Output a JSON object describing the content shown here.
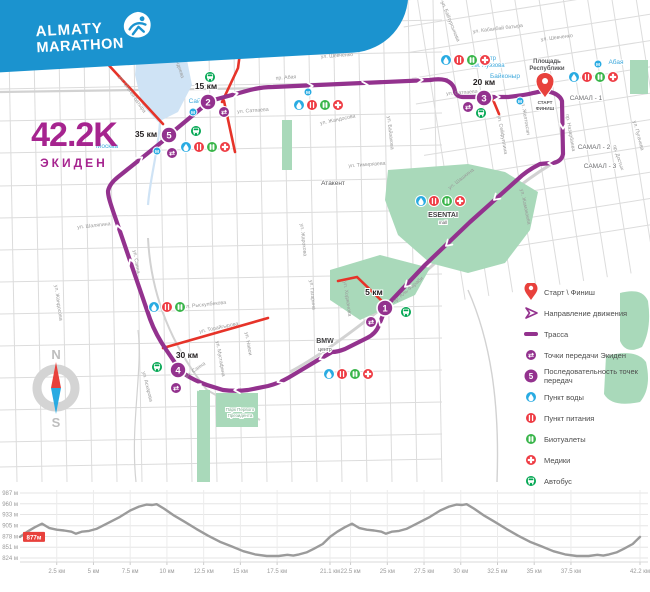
{
  "colors": {
    "brand_blue": "#1b93cf",
    "purple": "#93328e",
    "magenta": "#a6248f",
    "water_blue": "#29abe2",
    "food_red": "#ee3b43",
    "wc_green": "#39b54a",
    "bus_green": "#00a651",
    "park": "#a9d9ba",
    "water_area": "#cfe3f5",
    "red_road": "#e63329",
    "street": "#dcdcdc",
    "street_label": "#9a9a9a",
    "pin_red": "#e8413c",
    "chart_line": "#9b9b9b"
  },
  "logo": {
    "line1": "ALMATY",
    "line2": "MARATHON"
  },
  "race": {
    "distance": "42.2K",
    "type": "ЭКИДЕН"
  },
  "compass": {
    "north": "N",
    "south": "S"
  },
  "map": {
    "start": {
      "x": 545,
      "y": 88,
      "labels": [
        "СТАРТ",
        "ФИНИШ"
      ]
    },
    "km_markers": [
      {
        "num": "1",
        "label": "5 км",
        "x": 385,
        "y": 308,
        "lx": 374,
        "ly": 295
      },
      {
        "num": "2",
        "label": "15 км",
        "x": 208,
        "y": 102,
        "lx": 206,
        "ly": 89
      },
      {
        "num": "3",
        "label": "20 км",
        "x": 484,
        "y": 98,
        "lx": 484,
        "ly": 85
      },
      {
        "num": "4",
        "label": "30 км",
        "x": 178,
        "y": 370,
        "lx": 187,
        "ly": 358
      },
      {
        "num": "5",
        "label": "35 км",
        "x": 169,
        "y": 135,
        "lx": 146,
        "ly": 137
      }
    ],
    "icons": [
      [
        "water",
        446,
        60
      ],
      [
        "food",
        459,
        60
      ],
      [
        "wc",
        472,
        60
      ],
      [
        "medic",
        485,
        60
      ],
      [
        "water",
        574,
        77
      ],
      [
        "food",
        587,
        77
      ],
      [
        "wc",
        600,
        77
      ],
      [
        "medic",
        613,
        77
      ],
      [
        "water",
        299,
        105
      ],
      [
        "food",
        312,
        105
      ],
      [
        "wc",
        325,
        105
      ],
      [
        "medic",
        338,
        105
      ],
      [
        "water",
        186,
        147
      ],
      [
        "food",
        199,
        147
      ],
      [
        "wc",
        212,
        147
      ],
      [
        "medic",
        225,
        147
      ],
      [
        "water",
        329,
        374
      ],
      [
        "food",
        342,
        374
      ],
      [
        "wc",
        355,
        374
      ],
      [
        "medic",
        368,
        374
      ],
      [
        "water",
        421,
        201
      ],
      [
        "food",
        434,
        201
      ],
      [
        "wc",
        447,
        201
      ],
      [
        "medic",
        460,
        201
      ],
      [
        "water",
        154,
        307
      ],
      [
        "food",
        167,
        307
      ],
      [
        "wc",
        180,
        307
      ],
      [
        "bus",
        210,
        77
      ],
      [
        "bus",
        196,
        131
      ],
      [
        "bus",
        481,
        113
      ],
      [
        "bus",
        406,
        312
      ],
      [
        "bus",
        157,
        367
      ],
      [
        "exchange",
        224,
        112
      ],
      [
        "exchange",
        172,
        153
      ],
      [
        "exchange",
        468,
        107
      ],
      [
        "exchange",
        371,
        322
      ],
      [
        "exchange",
        176,
        388
      ],
      [
        "metro",
        308,
        92
      ],
      [
        "metro",
        193,
        112
      ],
      [
        "metro",
        520,
        101
      ],
      [
        "metro",
        598,
        64
      ],
      [
        "metro",
        157,
        151
      ]
    ],
    "streets": [
      [
        "ул. Шевченко",
        337,
        57,
        -4
      ],
      [
        "ул. Шевченко",
        557,
        39,
        -7
      ],
      [
        "ул. Кабанбай батыра",
        498,
        30,
        -7
      ],
      [
        "ул. Байтурсынова",
        449,
        22,
        68
      ],
      [
        "пр. Абая",
        286,
        79,
        -4
      ],
      [
        "ул. Сатпаева",
        253,
        112,
        -4
      ],
      [
        "ул. Сатпаева",
        462,
        94,
        -4
      ],
      [
        "ул. Тимирязева",
        367,
        166,
        -4
      ],
      [
        "ул. Жандосова",
        338,
        121,
        -12
      ],
      [
        "ул. Жарокова",
        302,
        240,
        84
      ],
      [
        "ул. Гагарина",
        311,
        295,
        84
      ],
      [
        "ул. Байзакова",
        389,
        133,
        84
      ],
      [
        "ул. Сейфуллина",
        501,
        135,
        80
      ],
      [
        "ул. Желтоксан",
        524,
        118,
        80
      ],
      [
        "пр. Назарбаева",
        569,
        133,
        80
      ],
      [
        "ул. Пугачева",
        637,
        136,
        75
      ],
      [
        "пр. Достык",
        617,
        158,
        72
      ],
      [
        "ул. Шашкина",
        462,
        180,
        -38
      ],
      [
        "ул. Жамакаева",
        524,
        207,
        78
      ],
      [
        "ул. Ходжанова",
        346,
        299,
        82
      ],
      [
        "пр. Аль-Фараби",
        409,
        291,
        -40
      ],
      [
        "ул. Навои",
        247,
        344,
        80
      ],
      [
        "ул. Мустафина",
        219,
        359,
        80
      ],
      [
        "ул. Торайгырова",
        219,
        329,
        -12
      ],
      [
        "ул. Рыскулбекова",
        205,
        306,
        -6
      ],
      [
        "ул. Саина",
        196,
        371,
        -35
      ],
      [
        "ул. Аскарова",
        146,
        387,
        76
      ],
      [
        "ул. Саина",
        135,
        262,
        80
      ],
      [
        "ул. Жандосова",
        57,
        303,
        82
      ],
      [
        "ул. Шаляпина",
        94,
        227,
        -6
      ],
      [
        "ул. Отеген батыра",
        131,
        95,
        55
      ],
      [
        "ул. Тлендиева",
        176,
        62,
        72
      ]
    ],
    "places_blue": [
      [
        "Сайран",
        200,
        103,
        6.5
      ],
      [
        "Москва",
        107,
        148,
        6.5
      ],
      [
        "Байконыр",
        505,
        78,
        6.5
      ],
      [
        "Театр",
        488,
        60,
        6
      ],
      [
        "им. Ауэзова",
        488,
        67,
        6
      ],
      [
        "Абая",
        616,
        64,
        6.5
      ]
    ],
    "places_dark": [
      [
        "Площадь",
        547,
        63,
        6,
        "bold",
        "#58585a"
      ],
      [
        "Республики",
        547,
        70,
        6,
        "bold",
        "#58585a"
      ],
      [
        "Атакент",
        333,
        185,
        6.5,
        "normal",
        "#58585a"
      ],
      [
        "САМАЛ - 1",
        586,
        100,
        6.5,
        "normal",
        "#6d6e71"
      ],
      [
        "САМАЛ - 2",
        594,
        149,
        6.5,
        "normal",
        "#6d6e71"
      ],
      [
        "САМАЛ - 3",
        600,
        168,
        6.5,
        "normal",
        "#6d6e71"
      ],
      [
        "BMW",
        325,
        343,
        7,
        "bold",
        "#414042"
      ],
      [
        "центр",
        325,
        351,
        5,
        "normal",
        "#58585a"
      ],
      [
        "ESENTAI",
        443,
        217,
        7,
        "bold",
        "#414042"
      ],
      [
        "mall",
        443,
        224,
        4.5,
        "normal",
        "#58585a"
      ],
      [
        "Парк Первого",
        240,
        411,
        4.5,
        "normal",
        "#79a98b"
      ],
      [
        "Президента",
        240,
        417,
        4.5,
        "normal",
        "#79a98b"
      ]
    ]
  },
  "legend": {
    "items": [
      {
        "icon": "pin",
        "label": "Старт \\ Финиш"
      },
      {
        "icon": "direction",
        "label": "Направление движения"
      },
      {
        "icon": "track",
        "label": "Трасса"
      },
      {
        "icon": "exchange",
        "label": "Точки передачи Экиден"
      },
      {
        "icon": "number",
        "label": "Последовательность точек передач",
        "num": "5"
      },
      {
        "icon": "water",
        "label": "Пункт воды"
      },
      {
        "icon": "food",
        "label": "Пункт питания"
      },
      {
        "icon": "wc",
        "label": "Биотуалеты"
      },
      {
        "icon": "medic",
        "label": "Медики"
      },
      {
        "icon": "bus",
        "label": "Автобус"
      }
    ]
  },
  "chart_data": {
    "type": "line",
    "title": "",
    "xlabel": "",
    "ylabel": "",
    "xlim": [
      0,
      42.2
    ],
    "ylim": [
      824,
      987
    ],
    "grid": true,
    "legend_position": "none",
    "start_badge": "877м",
    "x_ticks": [
      [
        "2.5 км",
        2.5
      ],
      [
        "5 км",
        5
      ],
      [
        "7.5 км",
        7.5
      ],
      [
        "10 км",
        10
      ],
      [
        "12.5 км",
        12.5
      ],
      [
        "15 км",
        15
      ],
      [
        "17.5 км",
        17.5
      ],
      [
        "21.1 км",
        21.1
      ],
      [
        "22.5 км",
        22.5
      ],
      [
        "25 км",
        25
      ],
      [
        "27.5 км",
        27.5
      ],
      [
        "30 км",
        30
      ],
      [
        "32.5 км",
        32.5
      ],
      [
        "35 км",
        35
      ],
      [
        "37.5 км",
        37.5
      ],
      [
        "42.2 км",
        42.2
      ]
    ],
    "y_ticks": [
      [
        "987 м",
        987
      ],
      [
        "960 м",
        960
      ],
      [
        "933 м",
        933
      ],
      [
        "905 м",
        905
      ],
      [
        "878 м",
        878
      ],
      [
        "851 м",
        851
      ],
      [
        "824 м",
        824
      ]
    ],
    "series": [
      {
        "name": "elevation",
        "points": [
          [
            0,
            877
          ],
          [
            0.5,
            890
          ],
          [
            1.0,
            901
          ],
          [
            1.5,
            910
          ],
          [
            2.0,
            899
          ],
          [
            2.5,
            895
          ],
          [
            3.0,
            893
          ],
          [
            3.5,
            890
          ],
          [
            3.8,
            885
          ],
          [
            4.2,
            890
          ],
          [
            4.7,
            892
          ],
          [
            5.2,
            897
          ],
          [
            6.0,
            912
          ],
          [
            6.8,
            927
          ],
          [
            7.5,
            943
          ],
          [
            8.1,
            953
          ],
          [
            8.6,
            958
          ],
          [
            9.0,
            957
          ],
          [
            9.3,
            959
          ],
          [
            9.8,
            948
          ],
          [
            10.5,
            930
          ],
          [
            11.2,
            915
          ],
          [
            12.0,
            897
          ],
          [
            12.8,
            880
          ],
          [
            13.6,
            865
          ],
          [
            14.4,
            853
          ],
          [
            15.2,
            841
          ],
          [
            16.0,
            833
          ],
          [
            16.8,
            829
          ],
          [
            17.6,
            829
          ],
          [
            18.2,
            832
          ],
          [
            18.6,
            830
          ],
          [
            19.0,
            833
          ],
          [
            19.5,
            838
          ],
          [
            20.0,
            847
          ],
          [
            20.6,
            859
          ],
          [
            21.1,
            877
          ],
          [
            21.6,
            890
          ],
          [
            22.1,
            901
          ],
          [
            22.6,
            910
          ],
          [
            23.1,
            899
          ],
          [
            23.6,
            895
          ],
          [
            24.1,
            893
          ],
          [
            24.6,
            890
          ],
          [
            24.9,
            885
          ],
          [
            25.3,
            890
          ],
          [
            25.8,
            892
          ],
          [
            26.3,
            897
          ],
          [
            27.1,
            912
          ],
          [
            27.9,
            927
          ],
          [
            28.6,
            943
          ],
          [
            29.2,
            953
          ],
          [
            29.7,
            958
          ],
          [
            30.1,
            957
          ],
          [
            30.4,
            959
          ],
          [
            30.9,
            948
          ],
          [
            31.6,
            930
          ],
          [
            32.3,
            915
          ],
          [
            33.1,
            897
          ],
          [
            33.9,
            880
          ],
          [
            34.7,
            865
          ],
          [
            35.5,
            853
          ],
          [
            36.3,
            841
          ],
          [
            37.1,
            833
          ],
          [
            37.9,
            829
          ],
          [
            38.7,
            829
          ],
          [
            39.3,
            832
          ],
          [
            39.7,
            830
          ],
          [
            40.1,
            833
          ],
          [
            40.6,
            838
          ],
          [
            41.1,
            847
          ],
          [
            41.7,
            859
          ],
          [
            42.2,
            877
          ]
        ]
      }
    ]
  }
}
